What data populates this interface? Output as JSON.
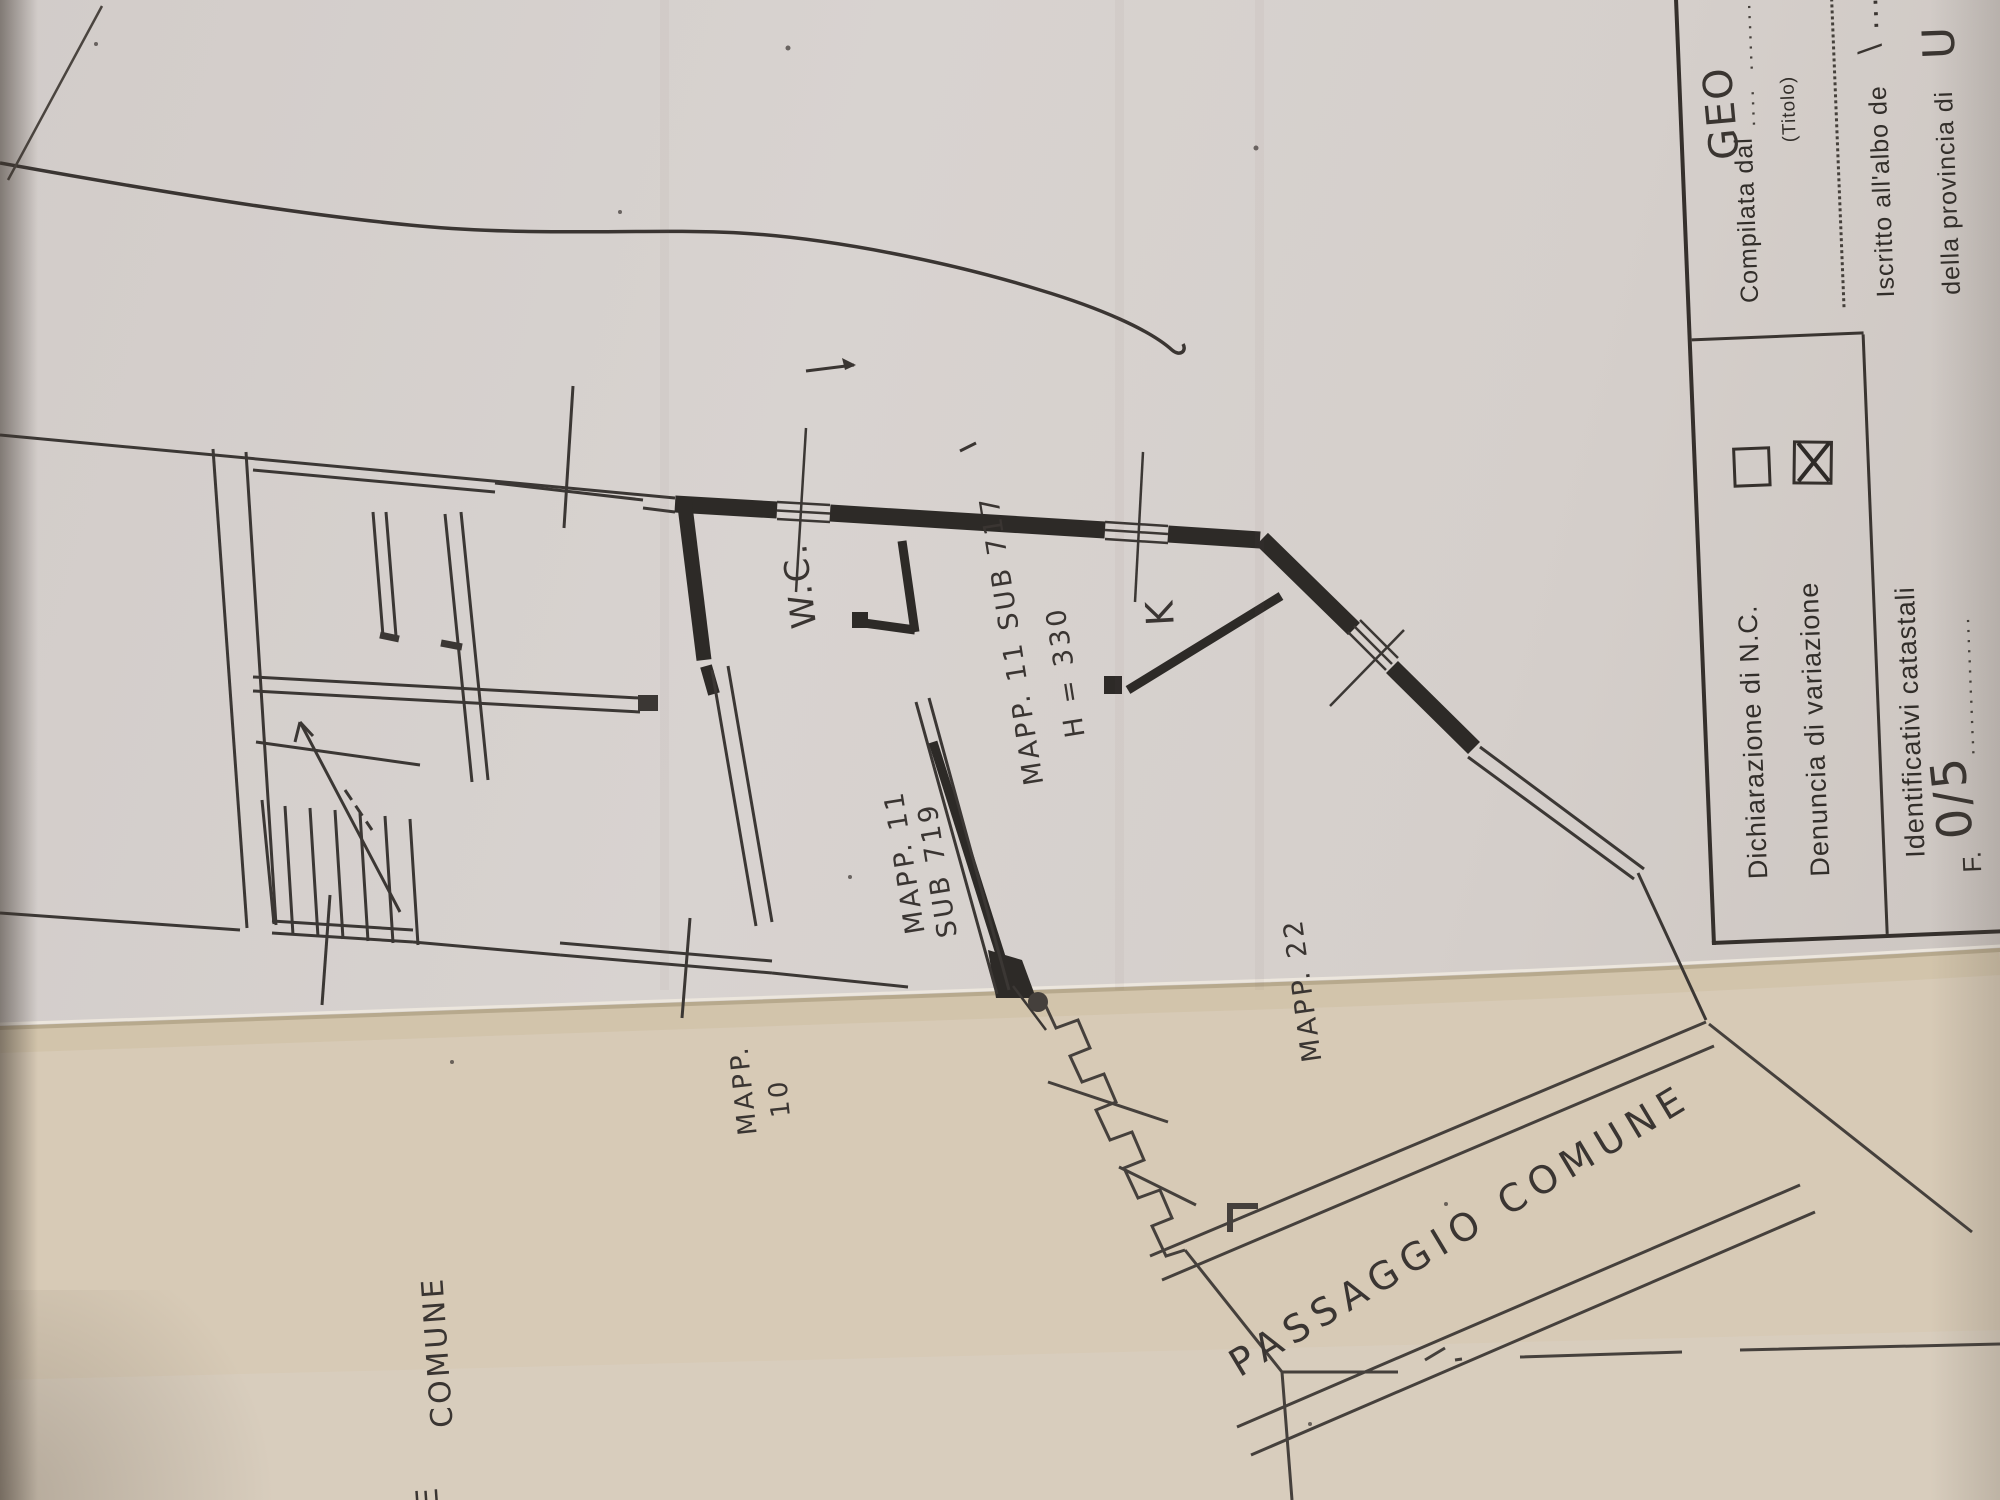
{
  "plan": {
    "wc": "W.C.",
    "k": "K",
    "mapp11sub717": "MAPP. 11 SUB 717",
    "h330": "H = 330",
    "mapp11": "MAPP. 11",
    "sub719": "SUB 719",
    "mapp": "MAPP.",
    "n10": "10",
    "mapp22": "MAPP. 22",
    "passaggio_comune": "PASSAGGIO COMUNE",
    "comune": "COMUNE",
    "comune_partial": "E"
  },
  "form": {
    "dichiarazione_label": "Dichiarazione di N.C.",
    "denuncia_label": "Denuncia di  variazione",
    "dichiarazione_checked": false,
    "denuncia_checked": true,
    "identificativi_label": "Identificativi catastali",
    "foglio_label": "F.",
    "foglio_value": "0/5",
    "foglio_dots": "..............",
    "compilata_label": "Compilata dal",
    "compilata_dots_pre": "....",
    "compilata_value": "GEO",
    "compilata_dots_post": ".......",
    "titolo_label": "(Titolo)",
    "iscritto_label": "Iscritto all'albo de",
    "iscritto_value": "\\ .....",
    "provincia_label": "della provincia di",
    "provincia_value": "U"
  },
  "colors": {
    "paper_upper": "#d6d0cc",
    "paper_lower": "#d7cab6",
    "fold_shadow": "#b7a98d",
    "ink": "#3a3532",
    "wall_ink": "#2d2a27"
  }
}
